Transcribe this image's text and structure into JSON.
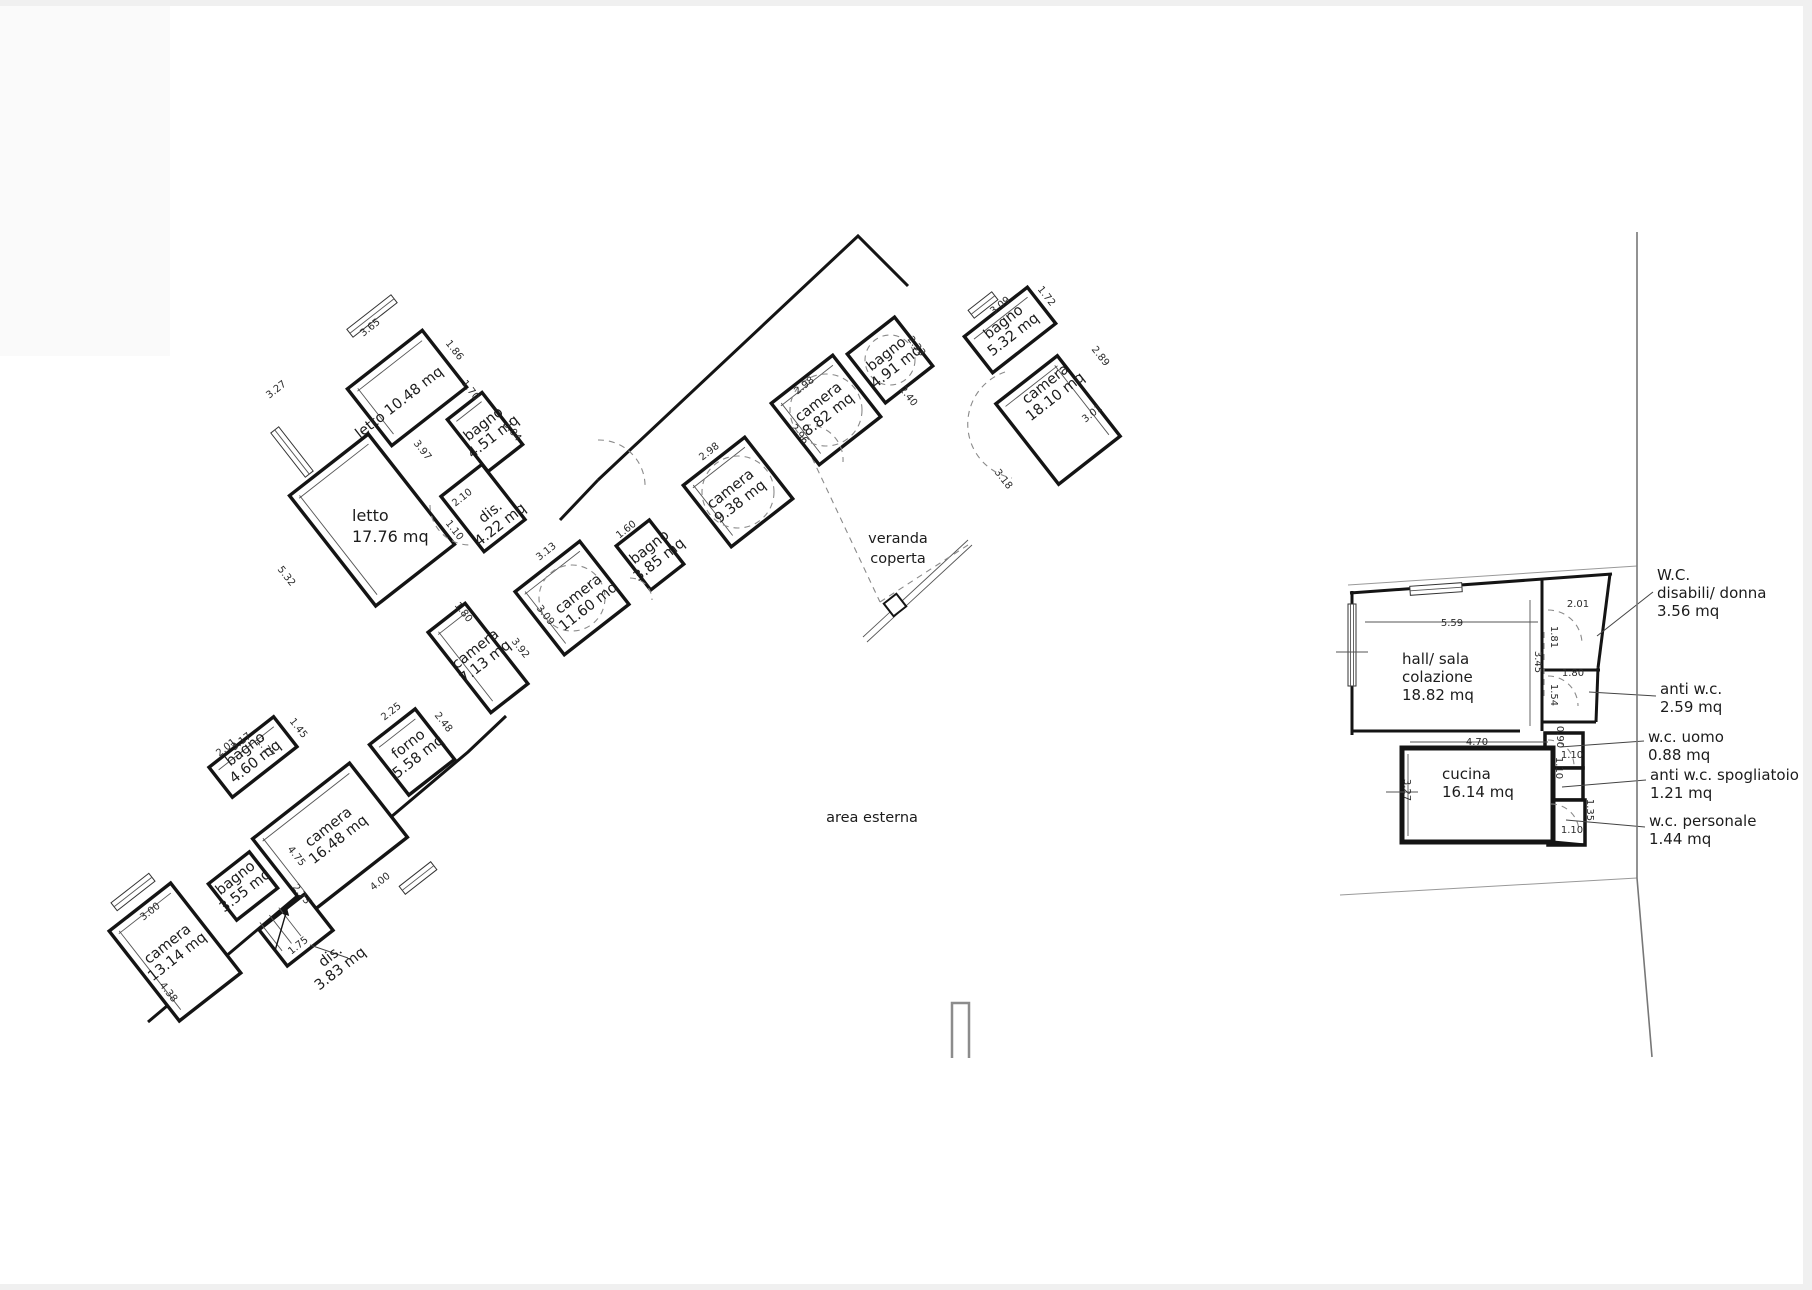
{
  "left_plan": {
    "rooms": [
      {
        "name": "letto",
        "area": "10.48 mq"
      },
      {
        "name": "bagno",
        "area": "4.51 mq"
      },
      {
        "name": "dis.",
        "area": "4.22 mq"
      },
      {
        "name": "camera",
        "area": "11.60 mq"
      },
      {
        "name": "bagno",
        "area": "3.85 mq"
      },
      {
        "name": "camera",
        "area": "9.38 mq"
      },
      {
        "name": "camera",
        "area": "8.82 mq"
      },
      {
        "name": "bagno",
        "area": "4.91 mq"
      },
      {
        "name": "bagno",
        "area": "5.32 mq"
      },
      {
        "name": "camera",
        "area": "18.10 mq"
      },
      {
        "name": "camera",
        "area": "7.13 mq"
      },
      {
        "name": "forno",
        "area": "5.58 mq"
      },
      {
        "name": "bagno",
        "area": "4.60 mq"
      },
      {
        "name": "camera",
        "area": "16.48 mq"
      },
      {
        "name": "bagno",
        "area": "3.55 mq"
      },
      {
        "name": "camera",
        "area": "13.14 mq"
      },
      {
        "name": "dis.",
        "area": "3.83 mq"
      }
    ],
    "letto_big": {
      "name": "letto",
      "area": "17.76 mq"
    },
    "veranda": {
      "line1": "veranda",
      "line2": "coperta"
    },
    "area_esterna": "area esterna"
  },
  "right_plan": {
    "hall": {
      "line1": "hall/ sala",
      "line2": "colazione",
      "line3": "18.82 mq"
    },
    "cucina": {
      "line1": "cucina",
      "line2": "16.14 mq"
    },
    "annotations": [
      {
        "line1": "W.C.",
        "line2": "disabili/ donna",
        "line3": "3.56 mq"
      },
      {
        "line1": "anti w.c.",
        "line2": "2.59 mq"
      },
      {
        "line1": "w.c. uomo",
        "line2": "0.88 mq"
      },
      {
        "line1": "anti w.c. spogliatoio",
        "line2": "1.21 mq"
      },
      {
        "line1": "w.c. personale",
        "line2": "1.44 mq"
      }
    ]
  },
  "dims": [
    "3.27",
    "5.32",
    "3.65",
    "1.86",
    "3.97",
    "1.70",
    "2.10",
    "1.10",
    "3.04",
    "3.13",
    "3.09",
    "1.80",
    "3.92",
    "2.25",
    "2.48",
    "3.17",
    "1.45",
    "4.75",
    "2.01",
    "1.77",
    "3.00",
    "4.38",
    "2.23",
    "1.75",
    "4.00",
    "2.98",
    "2.98",
    "2.96",
    "2.33",
    "2.40",
    "3.09",
    "1.72",
    "2.89",
    "3.01",
    "3.18",
    "1.60",
    "5.59",
    "2.01",
    "1.81",
    "3.45",
    "1.80",
    "1.54",
    "0.90",
    "4.70",
    "1.10",
    "1.10",
    "1.35",
    "1.10",
    "3.27"
  ],
  "colors": {
    "wall": "#141414",
    "dashed": "#8a8a8a",
    "boundary": "#777777",
    "paper": "#ffffff",
    "page_edge": "#f0f0f0"
  }
}
